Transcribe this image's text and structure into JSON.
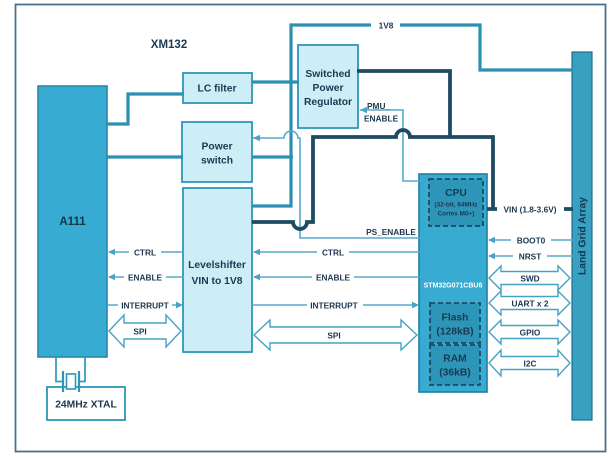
{
  "figure": {
    "module_label": "XM132"
  },
  "blocks": {
    "a111": {
      "label": "A111"
    },
    "lc_filter": {
      "label": "LC filter"
    },
    "power_switch": {
      "line1": "Power",
      "line2": "switch"
    },
    "switched_power_regulator": {
      "line1": "Switched",
      "line2": "Power",
      "line3": "Regulator"
    },
    "levelshifter": {
      "line1": "Levelshifter",
      "line2": "VIN to 1V8"
    },
    "mcu": {
      "part_number": "STM32G071CBU6",
      "cpu": {
        "title": "CPU",
        "detail1": "(32-bit, 64MHz",
        "detail2": "Cortex M0+)"
      },
      "flash": {
        "title": "Flash",
        "size": "(128kB)"
      },
      "ram": {
        "title": "RAM",
        "size": "(36kB)"
      }
    },
    "land_grid_array": {
      "label": "Land Grid Array"
    },
    "xtal": {
      "label": "24MHz XTAL"
    }
  },
  "nets": {
    "v1v8": "1V8",
    "vin": "VIN (1.8-3.6V)",
    "pmu_enable_l1": "PMU_",
    "pmu_enable_l2": "ENABLE",
    "ps_enable": "PS_ENABLE"
  },
  "signals_a111_levelshifter": {
    "ctrl": "CTRL",
    "enable": "ENABLE",
    "interrupt": "INTERRUPT",
    "spi": "SPI"
  },
  "signals_levelshifter_mcu": {
    "ctrl": "CTRL",
    "enable": "ENABLE",
    "interrupt": "INTERRUPT",
    "spi": "SPI"
  },
  "signals_mcu_lga": {
    "boot0": "BOOT0",
    "nrst": "NRST",
    "swd": "SWD",
    "uart": "UART x 2",
    "gpio": "GPIO",
    "i2c": "I2C"
  },
  "colors": {
    "wire_1v8_teal": "#2b91b1",
    "wire_vin_navy": "#1d4b61",
    "wire_signal_thin": "#58a9cb",
    "block_light_fill": "#cdeef7",
    "chip_fill": "#38abd2",
    "inner_chip_fill": "#2d96b8",
    "label_text": "#1c3850"
  }
}
